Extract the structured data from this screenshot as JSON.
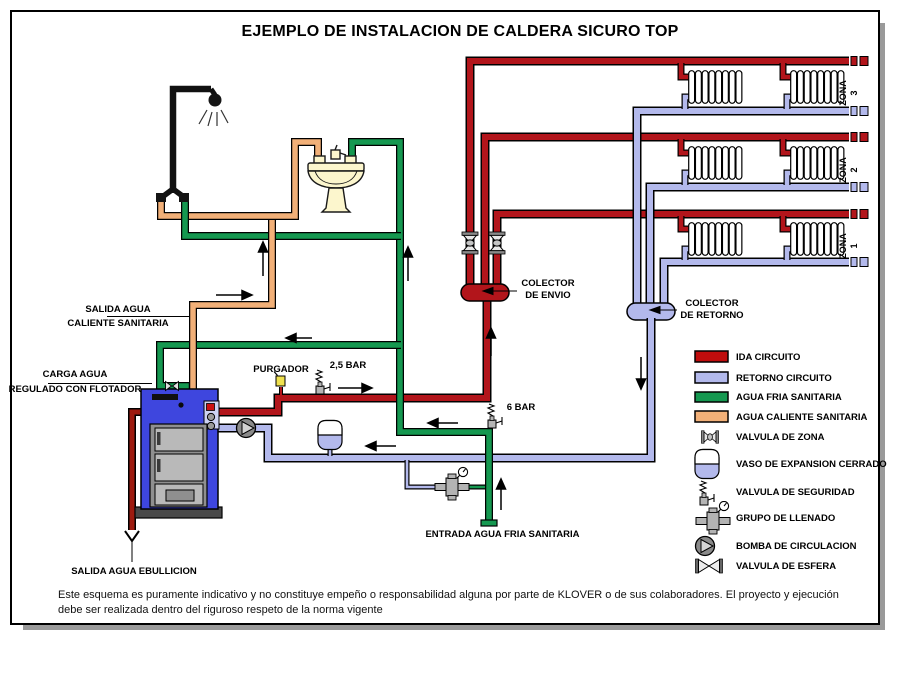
{
  "title": "EJEMPLO DE INSTALACION DE CALDERA SICURO TOP",
  "labels": {
    "salida_caliente_1": "SALIDA AGUA",
    "salida_caliente_2": "CALIENTE SANITARIA",
    "carga_1": "CARGA AGUA",
    "carga_2": "REGULADO CON FLOTADOR",
    "purgador": "PURGADOR",
    "bar25": "2,5 BAR",
    "bar6": "6 BAR",
    "colector_envio_1": "COLECTOR",
    "colector_envio_2": "DE ENVIO",
    "colector_retorno_1": "COLECTOR",
    "colector_retorno_2": "DE RETORNO",
    "entrada_fria": "ENTRADA AGUA FRIA SANITARIA",
    "salida_ebullicion": "SALIDA AGUA EBULLICION"
  },
  "zones": [
    {
      "name": "ZONA",
      "number": "3"
    },
    {
      "name": "ZONA",
      "number": "2"
    },
    {
      "name": "ZONA",
      "number": "1"
    }
  ],
  "legend": {
    "items": [
      {
        "icon": "ida-swatch",
        "label": "IDA CIRCUITO"
      },
      {
        "icon": "retorno-swatch",
        "label": "RETORNO CIRCUITO"
      },
      {
        "icon": "agua-fria-swatch",
        "label": "AGUA FRIA SANITARIA"
      },
      {
        "icon": "agua-caliente-swatch",
        "label": "AGUA CALIENTE SANITARIA"
      },
      {
        "icon": "zone-valve-icon",
        "label": "VALVULA DE ZONA"
      },
      {
        "icon": "expansion-vessel-icon",
        "label": "VASO DE EXPANSION CERRADO"
      },
      {
        "icon": "safety-valve-icon",
        "label": "VALVULA DE SEGURIDAD"
      },
      {
        "icon": "filling-group-icon",
        "label": "GRUPO DE LLENADO"
      },
      {
        "icon": "pump-icon",
        "label": "BOMBA DE CIRCULACION"
      },
      {
        "icon": "ball-valve-icon",
        "label": "VALVULA DE ESFERA"
      }
    ]
  },
  "disclaimer": {
    "line1": "Este esquema es puramente indicativo y no constituye empeño o responsabilidad alguna por parte de KLOVER o de sus colaboradores. El proyecto y ejecución",
    "line2": "debe ser realizada dentro del riguroso respeto de la norma vigente"
  },
  "colors": {
    "ida": "#B2151B",
    "retorno": "#B3B9EC",
    "agua_fria": "#159850",
    "agua_caliente": "#F2B078",
    "ebullicion": "#9E1B10",
    "boiler": "#3E46DE",
    "purgador_cap": "#EFE14E",
    "sink": "#FCF6CD"
  }
}
